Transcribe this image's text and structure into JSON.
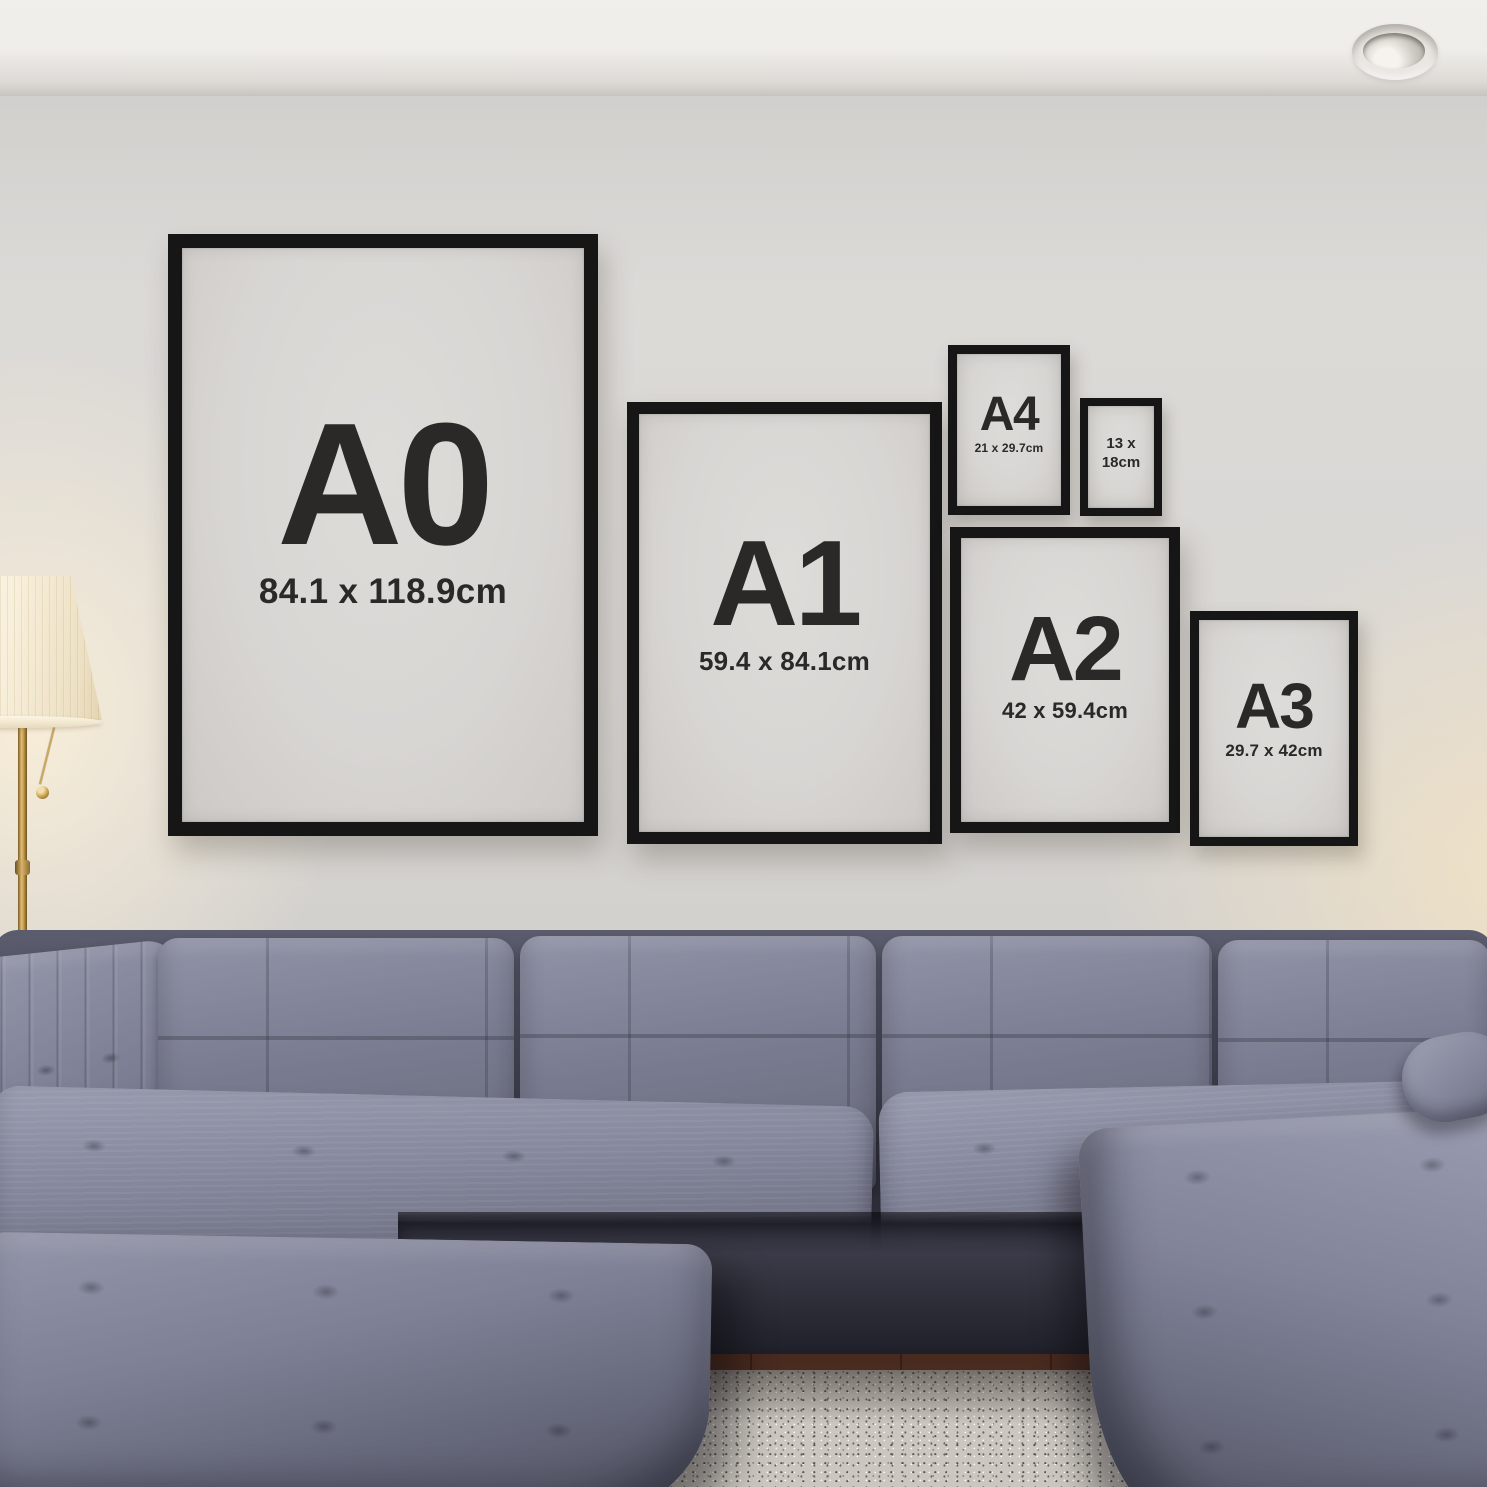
{
  "frames": [
    {
      "id": "a0",
      "label": "A0",
      "size": "84.1 x 118.9cm"
    },
    {
      "id": "a1",
      "label": "A1",
      "size": "59.4 x 84.1cm"
    },
    {
      "id": "a4",
      "label": "A4",
      "size": "21 x 29.7cm"
    },
    {
      "id": "13x18",
      "size_line1": "13 x",
      "size_line2": "18cm"
    },
    {
      "id": "a2",
      "label": "A2",
      "size": "42 x 59.4cm"
    },
    {
      "id": "a3",
      "label": "A3",
      "size": "29.7 x 42cm"
    }
  ],
  "colors": {
    "frame_black": "#161616",
    "poster_paper": "#d8d6d3",
    "poster_text": "#2a2927",
    "wall_light": "#dcdad7",
    "wall_dark": "#c7c4c1",
    "ceiling": "#efede9",
    "sofa_light": "#9193a7",
    "sofa_mid": "#717386",
    "sofa_dark": "#4e5060",
    "sofa_base": "#3c3d4a",
    "rug": "#cbc6bf",
    "floor_wood": "#47291f",
    "lamp_shade": "#f8efda",
    "lamp_brass": "#c9a24f"
  }
}
